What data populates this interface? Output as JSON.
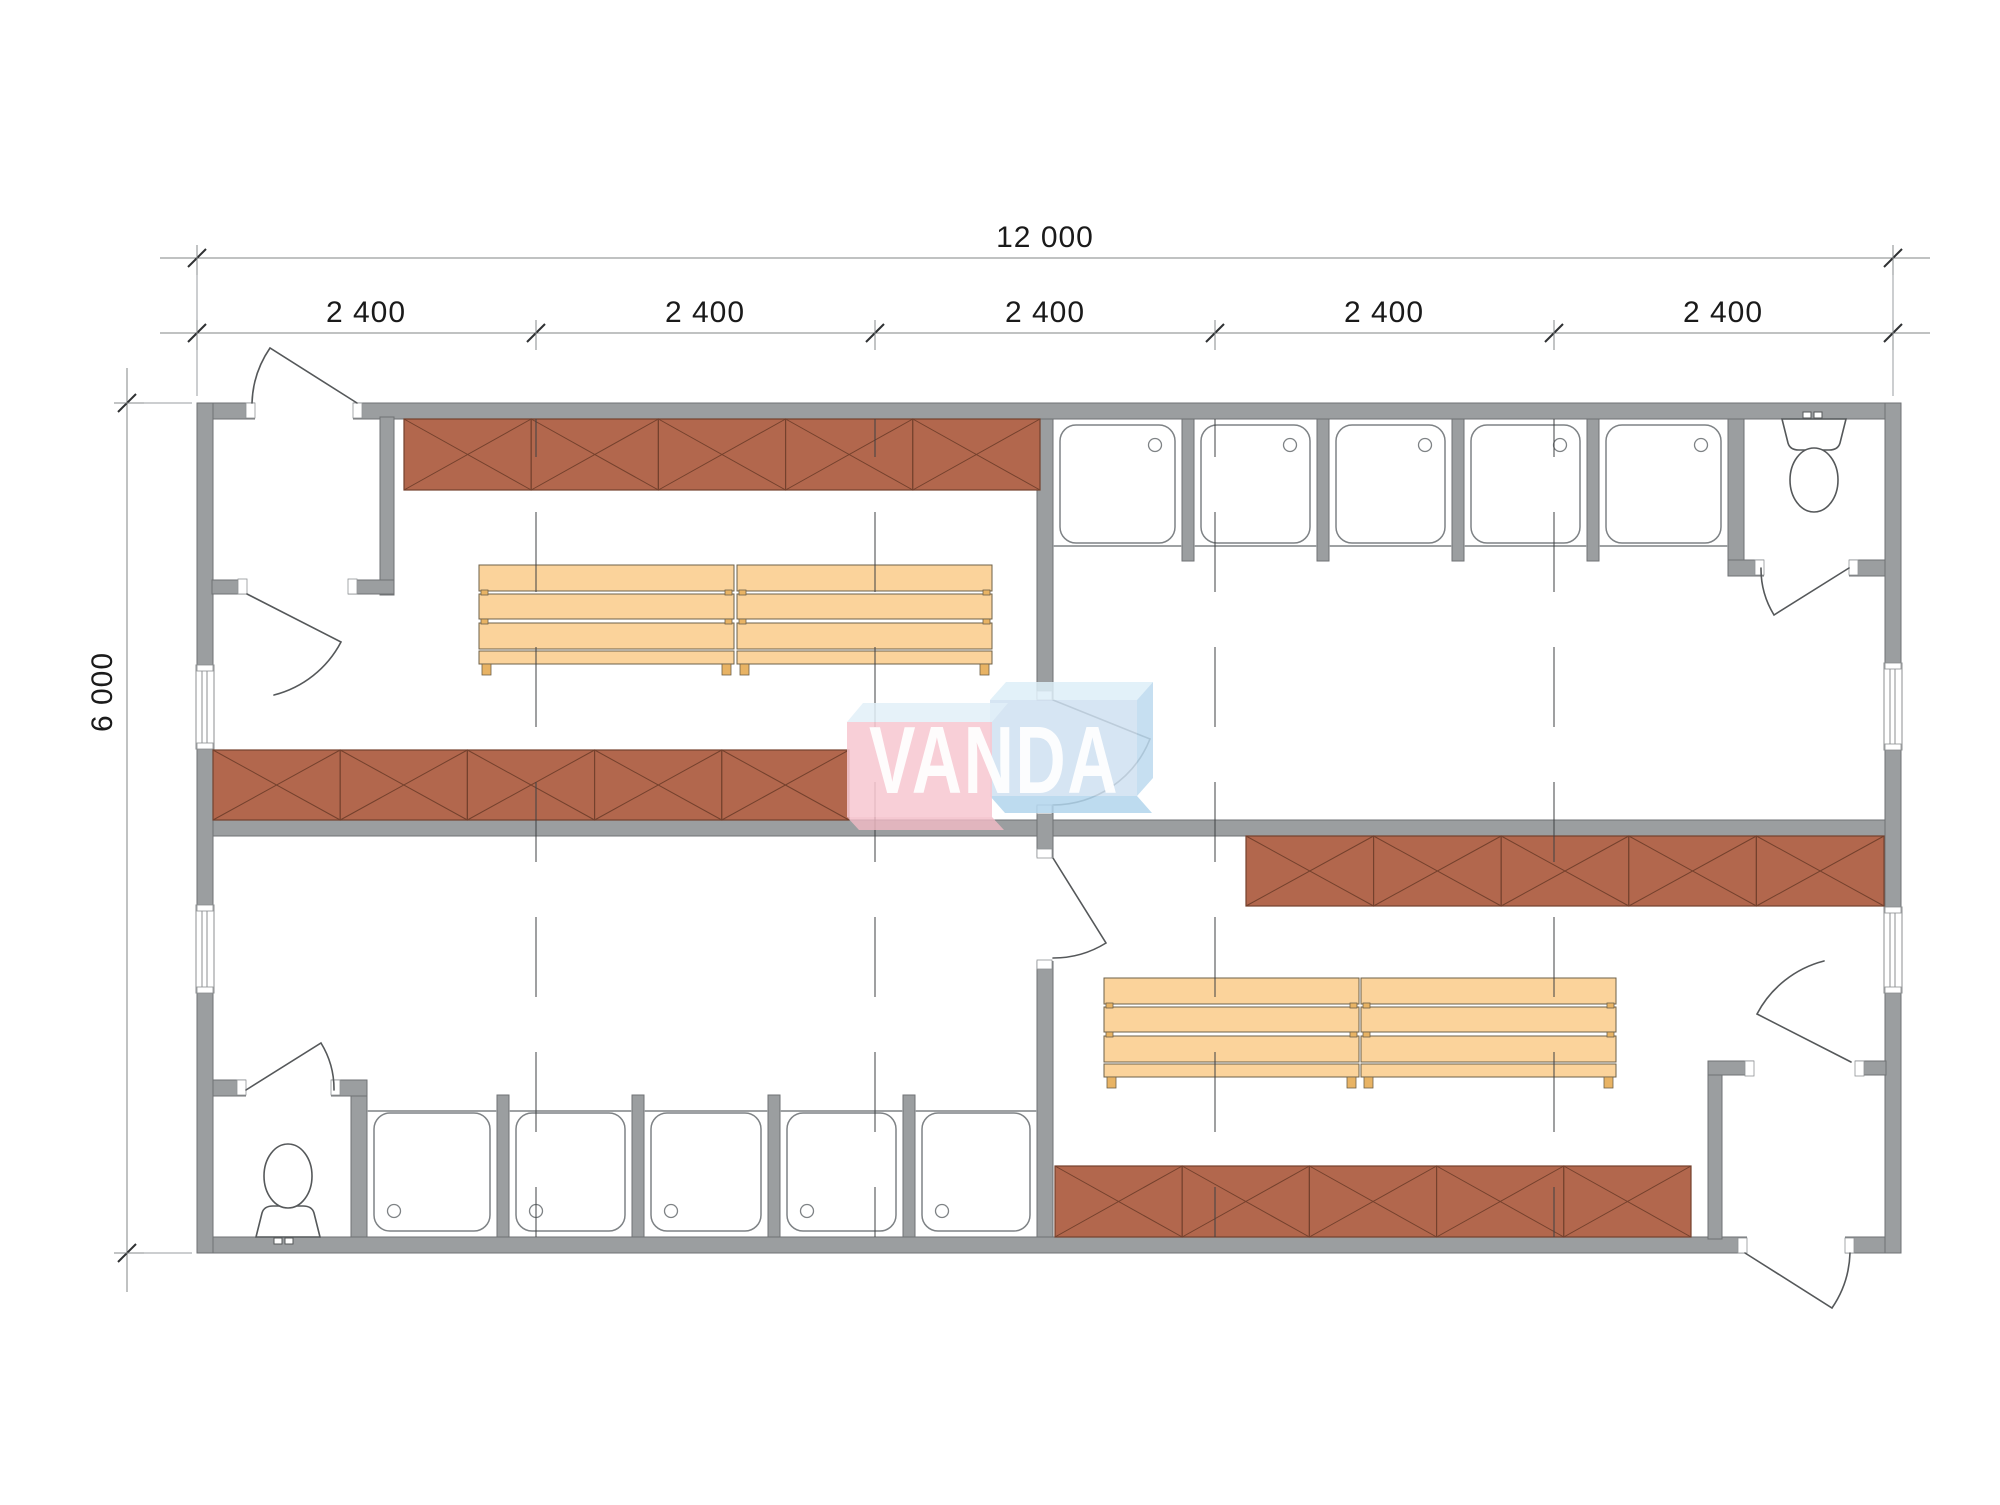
{
  "dimensions": {
    "total_width_label": "12 000",
    "segment_labels": [
      "2 400",
      "2 400",
      "2 400",
      "2 400",
      "2 400"
    ],
    "height_label": "6 000"
  },
  "watermark": {
    "text": "VANDA",
    "pink_front": "#f7c8d1",
    "pink_top": "#e2f0f8",
    "pink_shadow": "#f3bac6",
    "blue_front": "#cfe1f1",
    "blue_top": "#ddeef8",
    "blue_side": "#bcd9ee",
    "blue_shadow": "#b2d5ec",
    "text_color": "#ffffff"
  },
  "colors": {
    "background": "#ffffff",
    "wall_fill": "#9b9ea0",
    "wall_outline": "#6f7274",
    "locker_fill": "#b2674d",
    "locker_outline": "#74412d",
    "bench_fill": "#fbd39b",
    "bench_outline": "#6e6048",
    "bench_foot": "#e8b364",
    "fixture_outline": "#55585a",
    "tray_outline": "#7e8285",
    "threshold_line": "#9ea1a3",
    "grid_line": "#3f4143",
    "dimension_line": "#808486",
    "dimension_tick": "#2f3133",
    "dimension_text": "#1a1a1a"
  },
  "fixtures": {
    "locker_rows": 4,
    "lockers_per_row": 5,
    "shower_stalls": 10,
    "benches": 4,
    "toilets": 2,
    "doors": 8,
    "windows": 4
  }
}
